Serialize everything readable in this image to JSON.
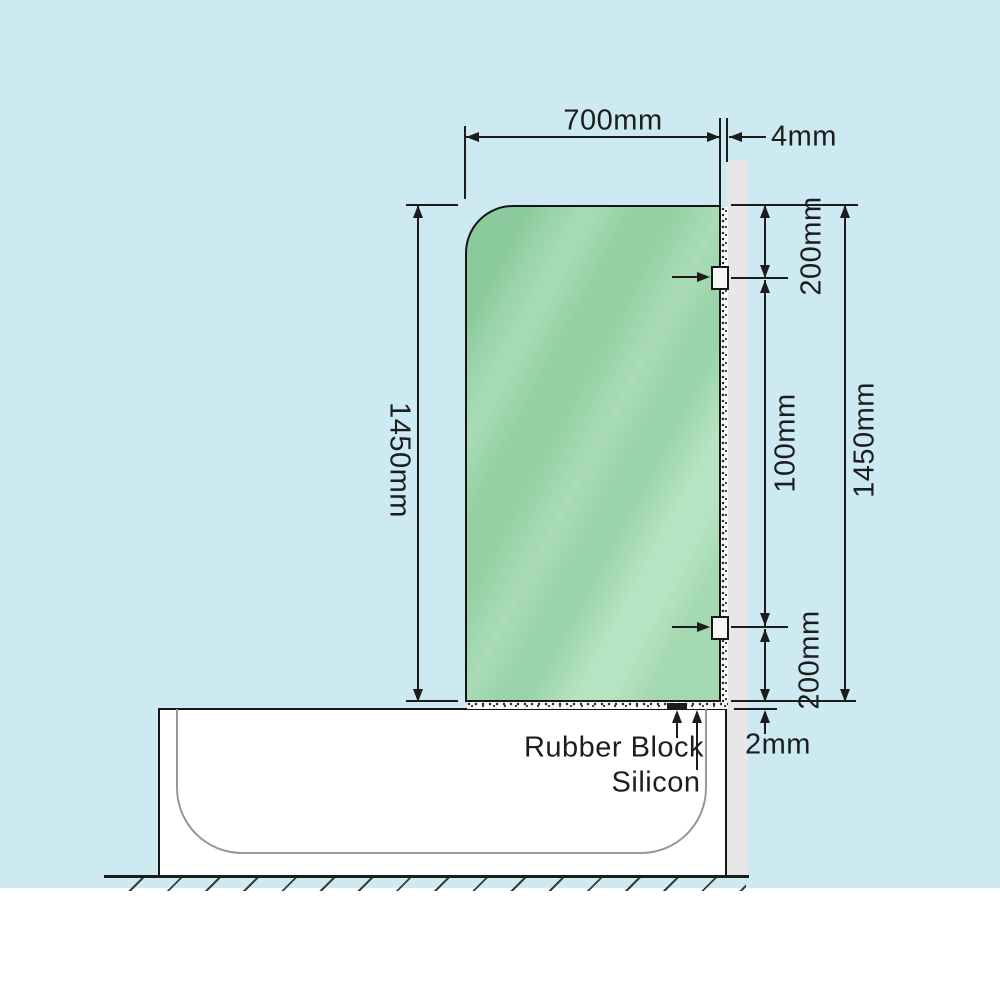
{
  "diagram": {
    "dimensions": {
      "glass_width": "700mm",
      "wall_gap": "4mm",
      "glass_height_left": "1450mm",
      "top_bracket_offset": "200mm",
      "bracket_spacing": "100mm",
      "bottom_bracket_offset": "200mm",
      "glass_height_right": "1450mm",
      "base_gap": "2mm"
    },
    "callouts": {
      "rubber_block": "Rubber Block",
      "silicon": "Silicon"
    },
    "colors": {
      "background": "#cdeaf3",
      "glass_green": "#9ad3a9",
      "wall_gray": "#e7e7e7",
      "line_black": "#1c1c1c",
      "tub_white": "#ffffff",
      "inner_tub_gray": "#979797"
    }
  }
}
